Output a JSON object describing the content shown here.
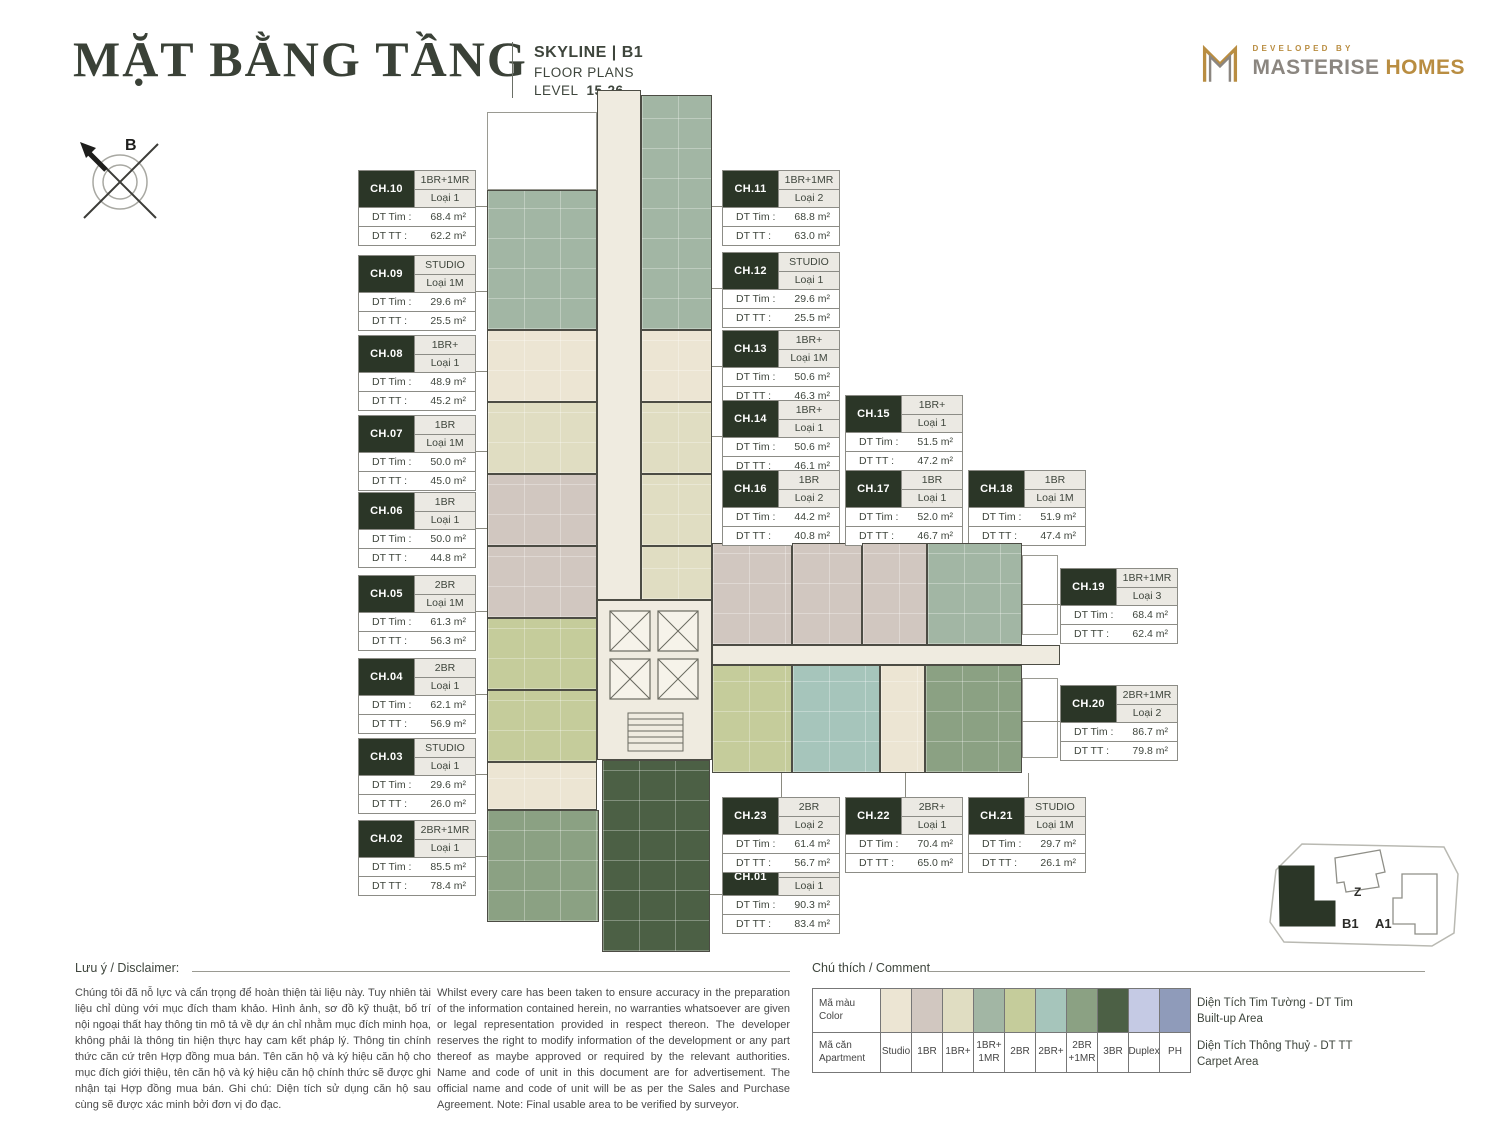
{
  "header": {
    "title": "MẶT BẰNG TẦNG",
    "project": "SKYLINE | B1",
    "subtitle": "FLOOR PLANS",
    "level_label": "LEVEL",
    "level_value": "15-26",
    "developed_by": "DEVELOPED BY",
    "brand_1": "MASTERISE",
    "brand_2": "HOMES"
  },
  "compass": {
    "label": "B"
  },
  "labels": {
    "dt_tim": "DT Tim :",
    "dt_tt": "DT TT :"
  },
  "units": [
    {
      "code": "CH.01",
      "type": "3BR",
      "variant": "Loại 1",
      "tim": "90.3 m²",
      "tt": "83.4 m²"
    },
    {
      "code": "CH.02",
      "type": "2BR+1MR",
      "variant": "Loại 1",
      "tim": "85.5 m²",
      "tt": "78.4 m²"
    },
    {
      "code": "CH.03",
      "type": "STUDIO",
      "variant": "Loại 1",
      "tim": "29.6 m²",
      "tt": "26.0 m²"
    },
    {
      "code": "CH.04",
      "type": "2BR",
      "variant": "Loại 1",
      "tim": "62.1 m²",
      "tt": "56.9 m²"
    },
    {
      "code": "CH.05",
      "type": "2BR",
      "variant": "Loại 1M",
      "tim": "61.3 m²",
      "tt": "56.3 m²"
    },
    {
      "code": "CH.06",
      "type": "1BR",
      "variant": "Loại 1",
      "tim": "50.0 m²",
      "tt": "44.8 m²"
    },
    {
      "code": "CH.07",
      "type": "1BR",
      "variant": "Loại 1M",
      "tim": "50.0 m²",
      "tt": "45.0 m²"
    },
    {
      "code": "CH.08",
      "type": "1BR+",
      "variant": "Loại 1",
      "tim": "48.9 m²",
      "tt": "45.2 m²"
    },
    {
      "code": "CH.09",
      "type": "STUDIO",
      "variant": "Loại 1M",
      "tim": "29.6 m²",
      "tt": "25.5 m²"
    },
    {
      "code": "CH.10",
      "type": "1BR+1MR",
      "variant": "Loại 1",
      "tim": "68.4 m²",
      "tt": "62.2 m²"
    },
    {
      "code": "CH.11",
      "type": "1BR+1MR",
      "variant": "Loại 2",
      "tim": "68.8 m²",
      "tt": "63.0 m²"
    },
    {
      "code": "CH.12",
      "type": "STUDIO",
      "variant": "Loại 1",
      "tim": "29.6 m²",
      "tt": "25.5 m²"
    },
    {
      "code": "CH.13",
      "type": "1BR+",
      "variant": "Loại 1M",
      "tim": "50.6 m²",
      "tt": "46.3 m²"
    },
    {
      "code": "CH.14",
      "type": "1BR+",
      "variant": "Loại 1",
      "tim": "50.6 m²",
      "tt": "46.1 m²"
    },
    {
      "code": "CH.15",
      "type": "1BR+",
      "variant": "Loại 1",
      "tim": "51.5 m²",
      "tt": "47.2 m²"
    },
    {
      "code": "CH.16",
      "type": "1BR",
      "variant": "Loại 2",
      "tim": "44.2 m²",
      "tt": "40.8 m²"
    },
    {
      "code": "CH.17",
      "type": "1BR",
      "variant": "Loại 1",
      "tim": "52.0 m²",
      "tt": "46.7 m²"
    },
    {
      "code": "CH.18",
      "type": "1BR",
      "variant": "Loại 1M",
      "tim": "51.9 m²",
      "tt": "47.4 m²"
    },
    {
      "code": "CH.19",
      "type": "1BR+1MR",
      "variant": "Loại 3",
      "tim": "68.4 m²",
      "tt": "62.4 m²"
    },
    {
      "code": "CH.20",
      "type": "2BR+1MR",
      "variant": "Loại 2",
      "tim": "86.7 m²",
      "tt": "79.8 m²"
    },
    {
      "code": "CH.21",
      "type": "STUDIO",
      "variant": "Loại 1M",
      "tim": "29.7 m²",
      "tt": "26.1 m²"
    },
    {
      "code": "CH.22",
      "type": "2BR+",
      "variant": "Loại 1",
      "tim": "70.4 m²",
      "tt": "65.0 m²"
    },
    {
      "code": "CH.23",
      "type": "2BR",
      "variant": "Loại 2",
      "tim": "61.4 m²",
      "tt": "56.7 m²"
    }
  ],
  "disclaimer": {
    "heading": "Lưu ý / Disclaimer:",
    "vi": "Chúng tôi đã nỗ lực và cẩn trọng để hoàn thiện tài liệu này. Tuy nhiên tài liệu chỉ dùng với mục đích tham khảo. Hình ảnh, sơ đồ kỹ thuật, bố trí nội ngoại thất hay thông tin mô tả về dự án chỉ nhằm mục đích minh họa, không phải là thông tin hiện thực hay cam kết pháp lý. Thông tin chính thức căn cứ trên Hợp đồng mua bán. Tên căn hộ và ký hiệu căn hộ cho mục đích giới thiệu, tên căn hộ và ký hiệu căn hộ chính thức sẽ được ghi nhận tại Hợp đồng mua bán. Ghi chú: Diện tích sử dụng căn hộ sau cùng sẽ được xác minh bởi đơn vị đo đạc.",
    "en": "Whilst every care has been taken to ensure accuracy in the preparation of the information contained herein, no warranties whatsoever are given or legal representation provided in respect thereon. The developer reserves the right to modify information of the development or any part thereof as maybe approved or required by the relevant authorities. Name and code of unit in this document are for advertisement. The official name and code of unit will be as per the Sales and Purchase Agreement. Note: Final usable area to be verified by surveyor."
  },
  "legend": {
    "heading": "Chú thích / Comment",
    "row1_label": "Mã màu\nColor",
    "row2_label": "Mã căn\nApartment",
    "items": [
      {
        "label": "Studio",
        "color": "#ece5d3"
      },
      {
        "label": "1BR",
        "color": "#d1c7c0"
      },
      {
        "label": "1BR+",
        "color": "#e0ddc2"
      },
      {
        "label": "1BR+\n1MR",
        "color": "#a2b6a4"
      },
      {
        "label": "2BR",
        "color": "#c5cc9b"
      },
      {
        "label": "2BR+",
        "color": "#a6c5bb"
      },
      {
        "label": "2BR\n+1MR",
        "color": "#8ba183"
      },
      {
        "label": "3BR",
        "color": "#4c6045"
      },
      {
        "label": "Duplex",
        "color": "#c5cae4"
      },
      {
        "label": "PH",
        "color": "#8f9bba"
      }
    ],
    "note1_vi": "Diện Tích Tim Tường - DT Tim",
    "note1_en": "Built-up Area",
    "note2_vi": "Diện Tích Thông Thuỷ - DT TT",
    "note2_en": "Carpet Area"
  },
  "keyplan": {
    "b1": "B1",
    "z": "Z",
    "a1": "A1"
  },
  "colors": {
    "accent_dark": "#2b3627",
    "gold": "#b98d41",
    "brand_gray": "#8b8680",
    "corridor": "#efebe0",
    "wall": "#4c4c44"
  }
}
